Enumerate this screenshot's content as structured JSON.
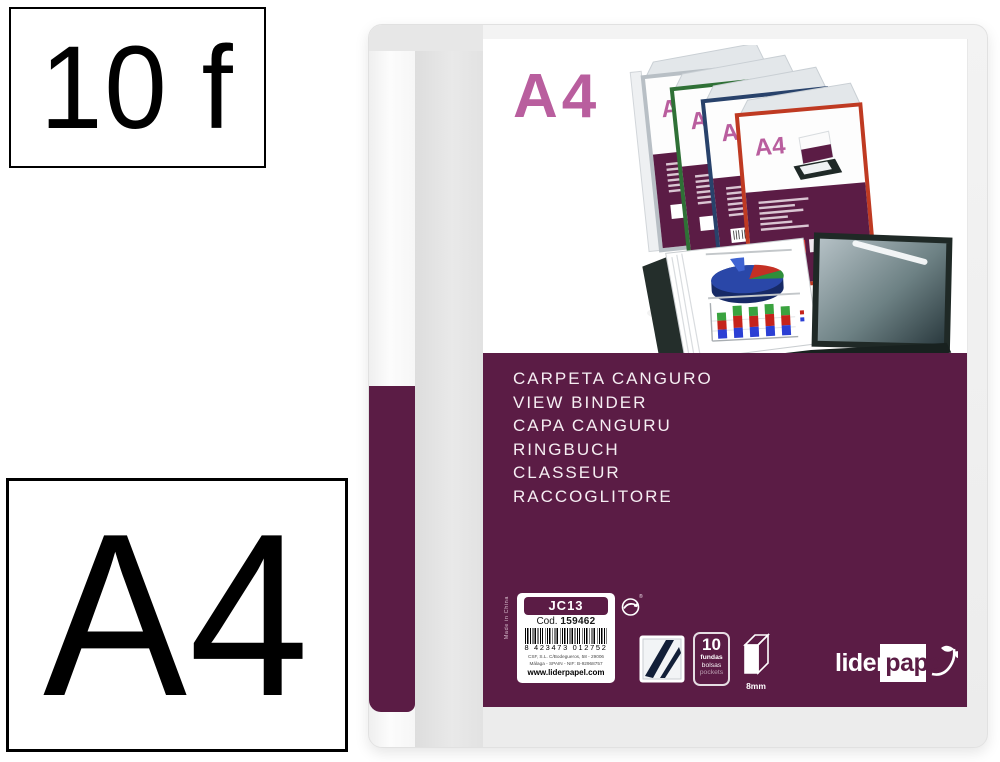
{
  "badges": {
    "sheet_count": "10 f",
    "format": "A4"
  },
  "folder_cover": {
    "format_label": "A4",
    "product_names": [
      "CARPETA CANGURO",
      "VIEW BINDER",
      "CAPA CANGURU",
      "RINGBUCH",
      "CLASSEUR",
      "RACCOGLITORE"
    ],
    "made_in": "Made in China",
    "label": {
      "model": "JC13",
      "code_prefix": "Cod.",
      "code_number": "159462",
      "barcode_digits": "8 423473 012752",
      "address_line_1": "CSF, S.L. C/Bodegueros, 58 - 29006",
      "address_line_2": "Málaga - SPAIN - NIF: B-92968757",
      "website": "www.liderpapel.com"
    },
    "green_dot_reg_mark": "®",
    "pockets_icon": {
      "count": "10",
      "labels": [
        "fundas",
        "bolsas",
        "pockets"
      ]
    },
    "spine_icon": {
      "width": "8mm"
    },
    "brand": {
      "part_white": "lider",
      "part_dark": "pape",
      "part_leaf": "l"
    }
  },
  "product_photo": {
    "mini_cover_label": "A4",
    "binder_trim_colors": [
      "#b8bfc5",
      "#2f7036",
      "#28426b",
      "#bf3a22"
    ]
  },
  "colors": {
    "maroon": "#5b1c45",
    "pink": "#b95e9e",
    "accent_blue": "#35a3dc",
    "accent_red": "#e8392c"
  }
}
